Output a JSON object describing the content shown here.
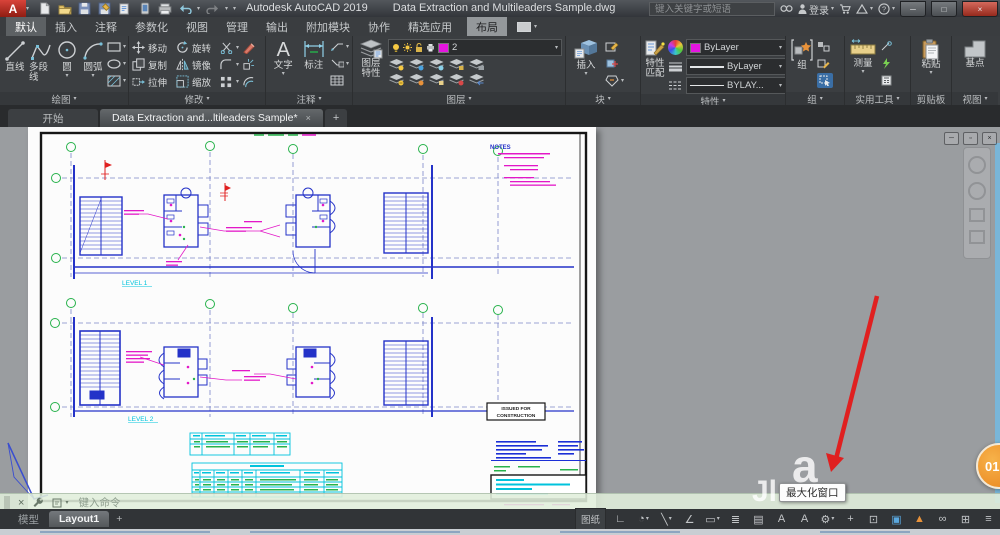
{
  "window": {
    "app_initial": "A",
    "product": "Autodesk AutoCAD 2019",
    "document": "Data Extraction and Multileaders Sample.dwg",
    "search_placeholder": "键入关键字或短语",
    "sign_in": "登录"
  },
  "icons": {
    "caret": "▾",
    "close": "×",
    "minimize": "─",
    "maximize": "□",
    "restore": "▫",
    "help": "?",
    "plus": "+",
    "menu": "≡"
  },
  "ribbon": {
    "tabs": [
      {
        "label": "默认"
      },
      {
        "label": "插入"
      },
      {
        "label": "注释"
      },
      {
        "label": "参数化"
      },
      {
        "label": "视图"
      },
      {
        "label": "管理"
      },
      {
        "label": "输出"
      },
      {
        "label": "附加模块"
      },
      {
        "label": "协作"
      },
      {
        "label": "精选应用"
      },
      {
        "label": "布局"
      }
    ],
    "panels": [
      {
        "title": "绘图",
        "items": [
          "直线",
          "多段线",
          "圆",
          "圆弧"
        ]
      },
      {
        "title": "修改",
        "items": [
          "移动",
          "旋转",
          "复制",
          "镜像",
          "拉伸",
          "缩放"
        ]
      },
      {
        "title": "注释",
        "items": [
          "文字",
          "标注"
        ]
      },
      {
        "title": "图层",
        "label_line1": "图层",
        "label_line2": "特性",
        "layer_current": "2"
      },
      {
        "title": "块",
        "items": [
          "插入"
        ]
      },
      {
        "title": "特性",
        "label_line1": "特性",
        "label_line2": "匹配",
        "color": "ByLayer",
        "lineweight": "ByLayer",
        "linetype": "BYLAY..."
      },
      {
        "title": "组",
        "items": [
          "组"
        ]
      },
      {
        "title": "实用工具",
        "items": [
          "测量"
        ]
      },
      {
        "title": "剪贴板",
        "items": [
          "粘贴"
        ]
      },
      {
        "title": "视图",
        "items": [
          "基点"
        ]
      }
    ]
  },
  "file_tabs": {
    "start": "开始",
    "active": "Data Extraction and...ltileaders Sample*"
  },
  "drawing": {
    "notes_title": "NOTES",
    "level_1": "LEVEL 1",
    "level_2": "LEVEL 2",
    "stamp": [
      "ISSUED FOR",
      "CONSTRUCTION"
    ]
  },
  "overlay": {
    "tooltip": "最大化窗口",
    "step_badge": "01"
  },
  "command_line": {
    "prompt": "键入命令"
  },
  "layout_bar": {
    "model": "模型",
    "layout": "Layout1",
    "add": "+"
  },
  "status_bar": {
    "paper_space": "图纸",
    "icons": [
      {
        "name": "ortho-mode",
        "glyph": "∟"
      },
      {
        "name": "polar-tracking",
        "glyph": "◔"
      },
      {
        "name": "isodraft",
        "glyph": "╲"
      },
      {
        "name": "object-snap-tracking",
        "glyph": "∠"
      },
      {
        "name": "dynamic-input",
        "glyph": "▭"
      },
      {
        "name": "lineweight-display",
        "glyph": "≣"
      },
      {
        "name": "transparency",
        "glyph": "▤"
      },
      {
        "name": "annotation-visibility",
        "glyph": "A"
      },
      {
        "name": "annotation-autoscale",
        "glyph": "A"
      },
      {
        "name": "workspace-switching",
        "glyph": "⚙"
      },
      {
        "name": "annotation-monitor",
        "glyph": "+"
      },
      {
        "name": "units",
        "glyph": "⊡"
      },
      {
        "name": "graphics-performance",
        "glyph": "▣"
      },
      {
        "name": "performance-recorder",
        "glyph": "▲"
      },
      {
        "name": "autodesk-online",
        "glyph": "∞"
      },
      {
        "name": "clean-screen",
        "glyph": "⊞"
      },
      {
        "name": "customize",
        "glyph": "≡"
      }
    ]
  },
  "colors": {
    "accent_magenta": "#e515e0",
    "blue_line": "#2432c8",
    "cyan": "#00c3dc",
    "green": "#27b24b",
    "red_arrow": "#e02020",
    "paper": "#fcfcfc",
    "canvas_gray": "#9a9da0"
  }
}
